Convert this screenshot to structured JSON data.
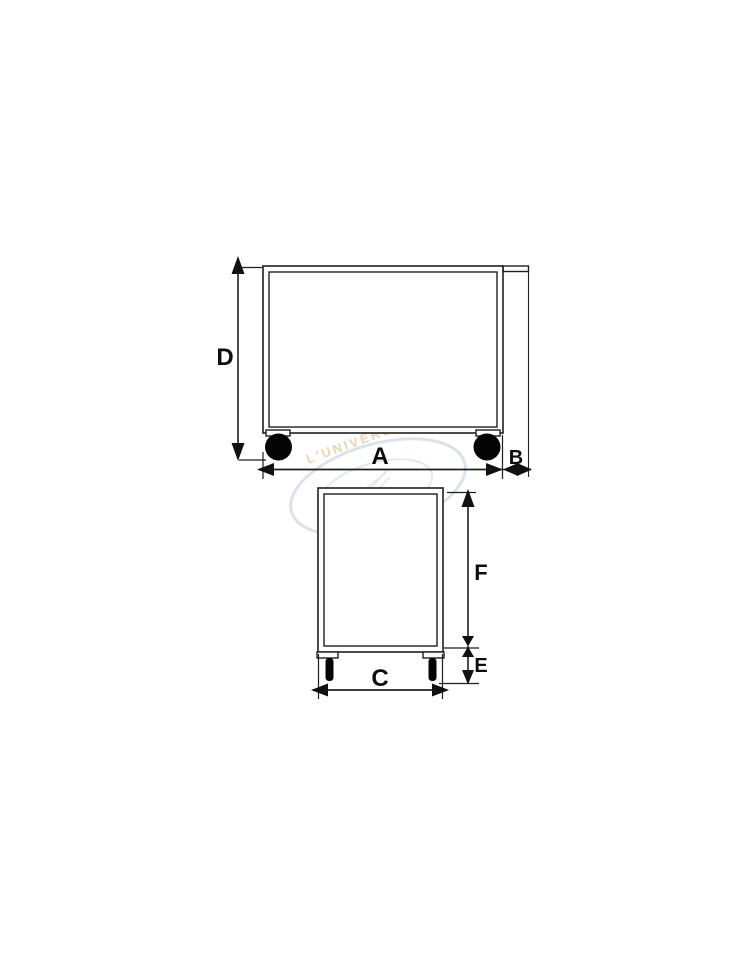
{
  "image": {
    "description": "Technical dimension diagram of a platform trolley shown in side view (top) and front view (bottom)",
    "background_color": "#ffffff"
  },
  "diagram": {
    "stroke_color": "#1f1f1f",
    "label_color": "#0d0d0d",
    "wheel_color": "#050505",
    "side_view": {
      "labels": {
        "height": "D",
        "length": "A",
        "handle_overhang": "B"
      }
    },
    "front_view": {
      "labels": {
        "body_height": "F",
        "leg_height": "E",
        "width": "C"
      }
    }
  },
  "watermark": {
    "line1": "L'UNIVERSO",
    "line2": "DEI CARRELLI",
    "swoosh_color": "#ccd9e8",
    "inner_graphic_color": "#d5dfec",
    "line1_color": "#e9cda6",
    "line2_color": "#f0c0ba"
  }
}
